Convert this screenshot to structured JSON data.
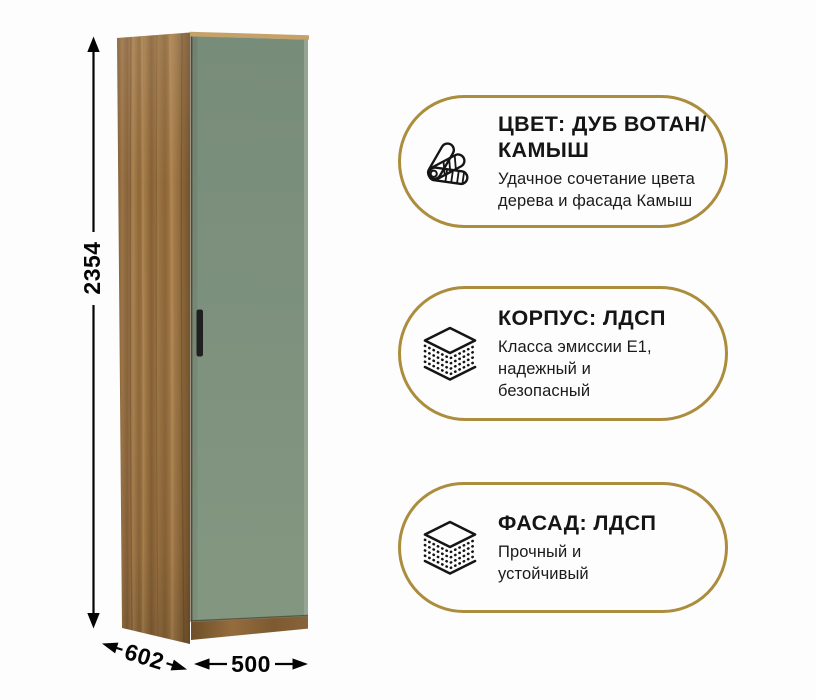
{
  "background": "#fdfdfd",
  "accent_gold": "#ab8d3d",
  "wardrobe": {
    "wood_color": "#9a7346",
    "door_color": "#7d917e",
    "handle_color": "#202020",
    "dimensions": {
      "height": "2354",
      "depth": "602",
      "width": "500"
    }
  },
  "badges": [
    {
      "icon": "color-swatch-fan-icon",
      "title_lines": [
        "ЦВЕТ: ДУБ ВОТАН/",
        "КАМЫШ"
      ],
      "subtitle_lines": [
        "Удачное сочетание цвета",
        "дерева и фасада Камыш"
      ]
    },
    {
      "icon": "layers-icon",
      "title_lines": [
        "КОРПУС: ЛДСП"
      ],
      "subtitle_lines": [
        "Класса эмиссии Е1,",
        "надежный и",
        "безопасный"
      ]
    },
    {
      "icon": "layers-icon",
      "title_lines": [
        "ФАСАД: ЛДСП"
      ],
      "subtitle_lines": [
        "Прочный и",
        "устойчивый"
      ]
    }
  ]
}
